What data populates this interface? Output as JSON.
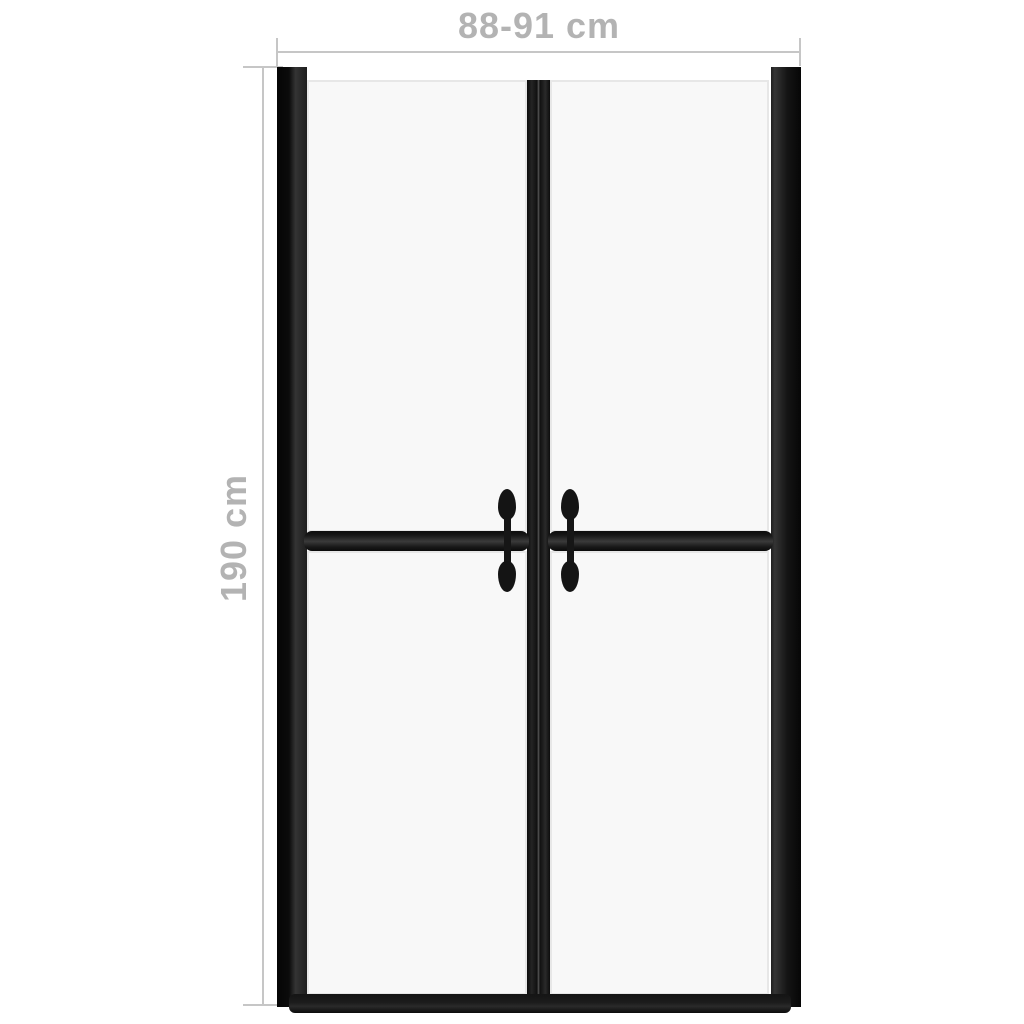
{
  "dimension_annotations": {
    "width": {
      "label": "88-91 cm"
    },
    "height": {
      "label": "190 cm"
    }
  },
  "diagram": {
    "subject": "shower-door-front-view",
    "panel_count": 4,
    "handle_count": 2
  },
  "colors": {
    "background": "#ffffff",
    "dimension_line": "#c6c6c6",
    "dimension_text": "#b3b3b3",
    "frame_black": "#141414",
    "frame_highlight": "#3a3a3a",
    "glass_fill": "#f8f8f8",
    "glass_edge": "#e7e7e7"
  }
}
